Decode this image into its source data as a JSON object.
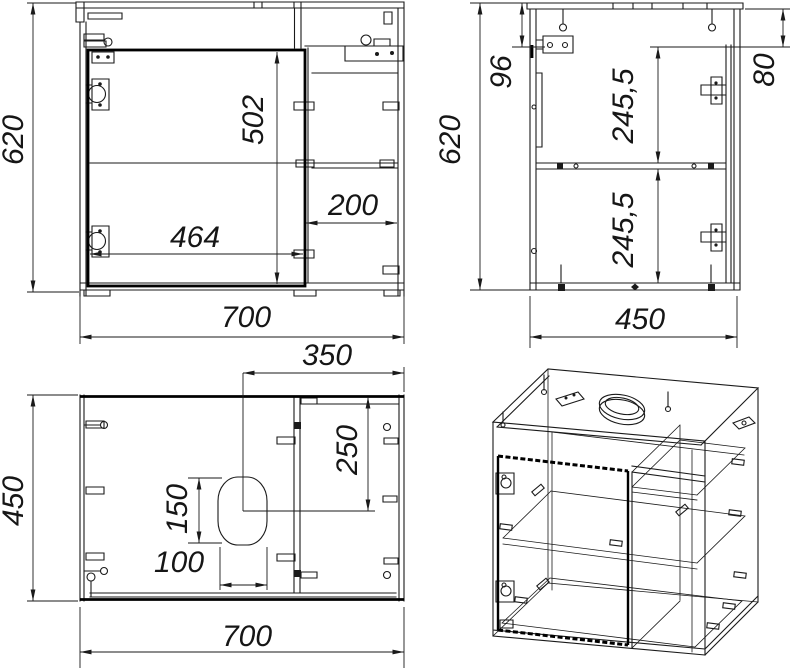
{
  "palette": {
    "background": "#ffffff",
    "line": "#1a1a1a"
  },
  "views": {
    "front": {
      "dims": {
        "height": "620",
        "door_height": "502",
        "left_section_width": "464",
        "right_section_width": "200",
        "width": "700"
      }
    },
    "side": {
      "dims": {
        "height": "620",
        "hinge_top_offset": "96",
        "rail_height": "80",
        "upper_section": "245,5",
        "lower_section": "245,5",
        "depth": "450"
      }
    },
    "top": {
      "dims": {
        "depth": "450",
        "cutout_center_from_right": "350",
        "cutout_center_from_front": "250",
        "cutout_length": "150",
        "cutout_width": "100",
        "width": "700"
      }
    }
  }
}
